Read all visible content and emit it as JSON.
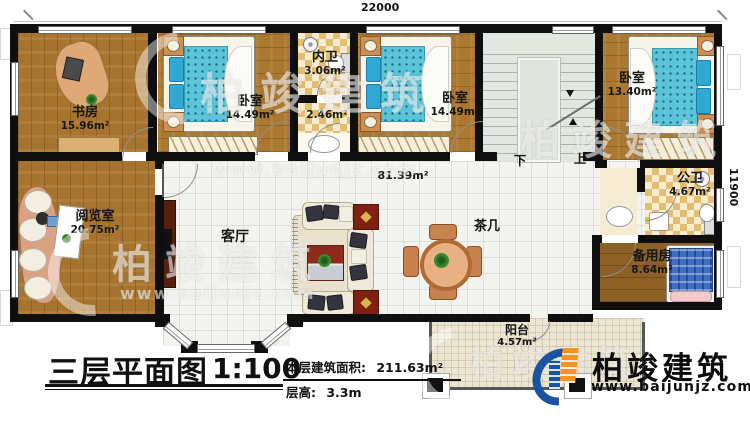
{
  "dimensions": {
    "top": "22000",
    "right": "11900"
  },
  "rooms": {
    "study": {
      "name": "书房",
      "area": "15.96m²"
    },
    "bedroom1": {
      "name": "卧室",
      "area": "14.49m²"
    },
    "inner_bath": {
      "name": "内卫",
      "area": "3.06m²"
    },
    "corridor": {
      "area": "2.46m²"
    },
    "bedroom2": {
      "name": "卧室",
      "area": "14.49m²"
    },
    "bedroom3": {
      "name": "卧室",
      "area": "13.40m²"
    },
    "public_bath": {
      "name": "公卫",
      "area": "4.67m²"
    },
    "reading": {
      "name": "阅览室",
      "area": "20.75m²"
    },
    "living": {
      "name": "客厅",
      "area": "81.39m²"
    },
    "tea_table": {
      "name": "茶几"
    },
    "spare": {
      "name": "备用房",
      "area": "8.64m²"
    },
    "balcony": {
      "name": "阳台",
      "area": "4.57m²"
    }
  },
  "stair": {
    "down": "下",
    "up": "上"
  },
  "title_block": {
    "title": "三层平面图",
    "scale": "1:100",
    "area_label": "本层建筑面积:",
    "area_value": "211.63m²",
    "floor_height_label": "层高:",
    "floor_height_value": "3.3m"
  },
  "brand": {
    "name": "柏竣建筑",
    "website": "www.baijunjz.com"
  },
  "watermark": {
    "text": "柏竣建筑",
    "website": "www.baijunjz.com"
  },
  "colors": {
    "wall": "#0f0f0f",
    "wood": "#a7742f",
    "checker_tile": "#e2bd72",
    "living_tile": "#f3f3ef",
    "bed_blue": "#5bc4d8",
    "brand_blue": "#1a53a0",
    "brand_orange": "#f7941d"
  }
}
